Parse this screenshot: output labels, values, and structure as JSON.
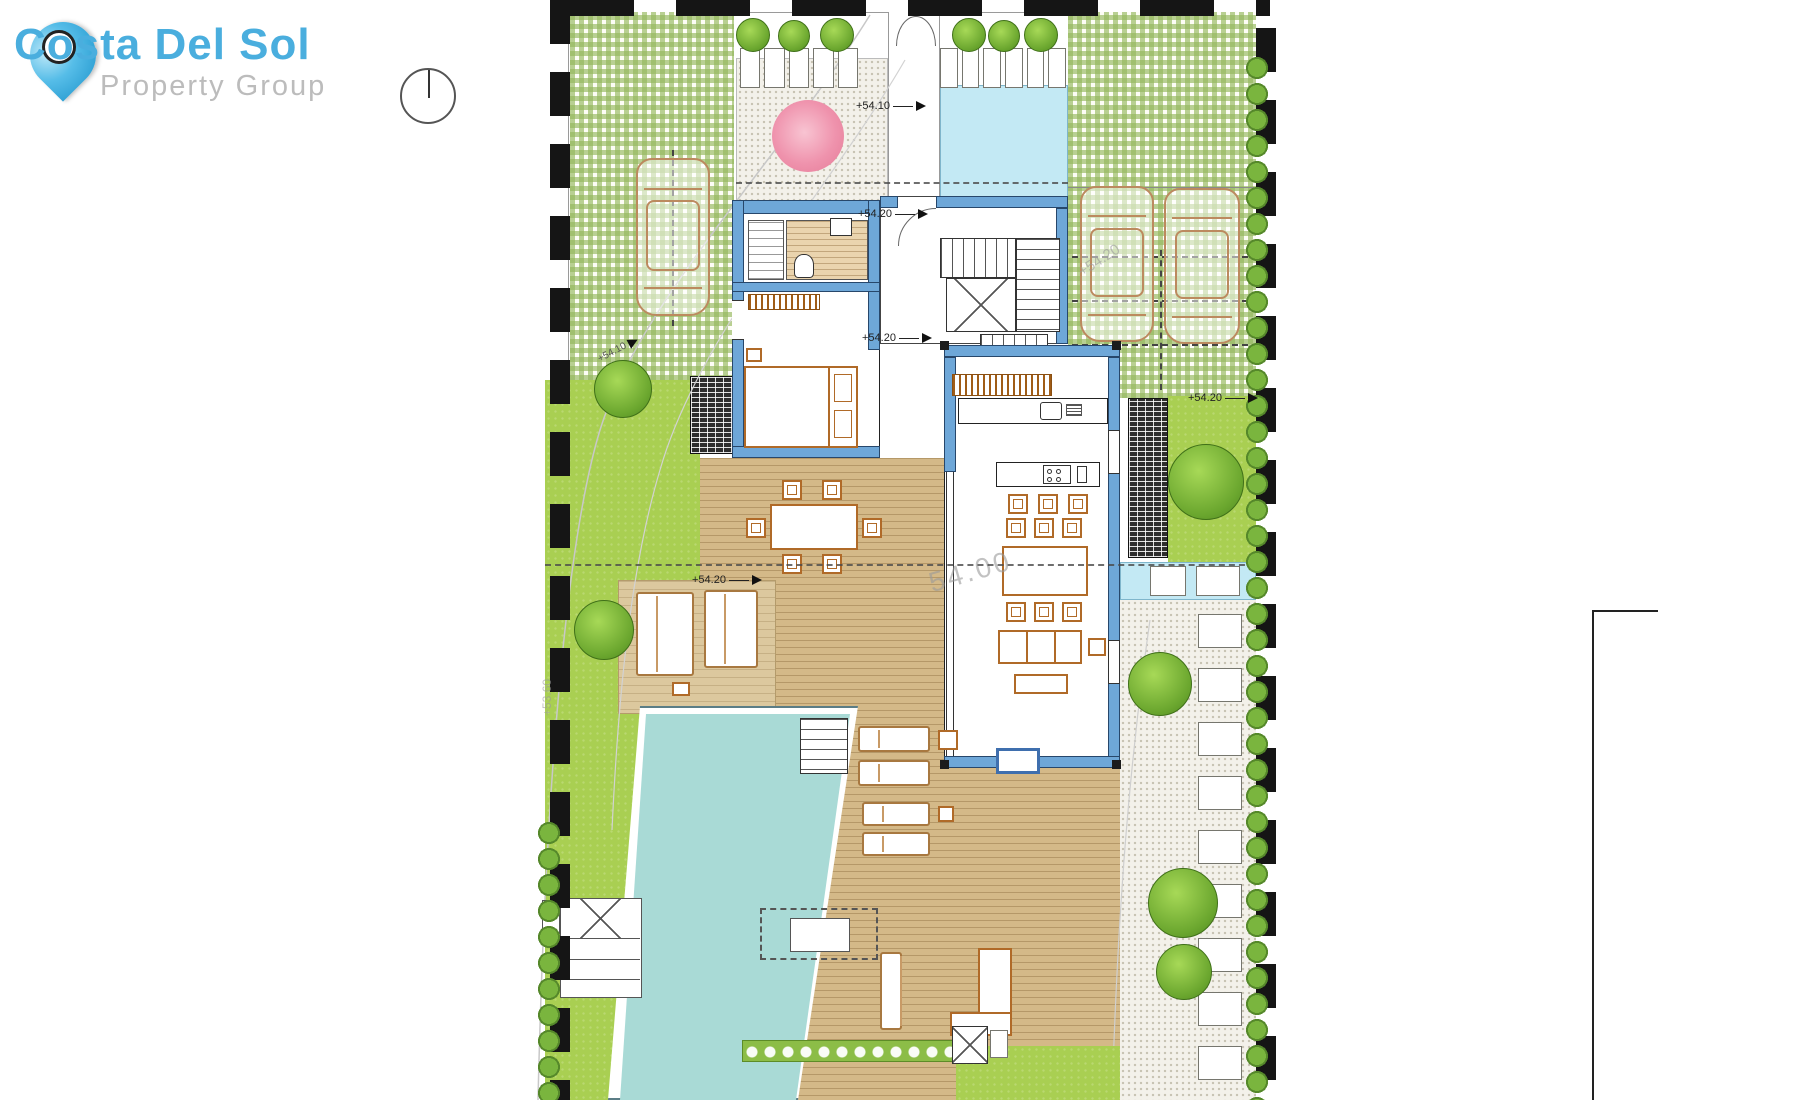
{
  "branding": {
    "name": "Costa Del Sol",
    "tagline": "Property Group"
  },
  "levels": {
    "entrance_path": "+54.10",
    "entry_hall": "+54.20",
    "stair_landing": "+54.20",
    "terrace_daybeds": "+54.20",
    "garden_east": "+54.20",
    "driveway_edge": "+54.10"
  },
  "watermarks": {
    "living_room": "54.00",
    "parking": "+54.20",
    "boundary_west": "+53.60"
  },
  "colors": {
    "brand_blue": "#4aaede",
    "brand_gray": "#bcbcbc",
    "wall_blue": "#6ea7d8",
    "pool_water": "#a9dad6",
    "entrance_water": "#c3e9f4",
    "lawn_green": "#a9cf52",
    "paver_grid_green": "#94b75c",
    "deck_wood": "#d4b988",
    "furniture_brown": "#b06a28",
    "hedge_green": "#7ab53e",
    "boundary_black": "#151515"
  }
}
